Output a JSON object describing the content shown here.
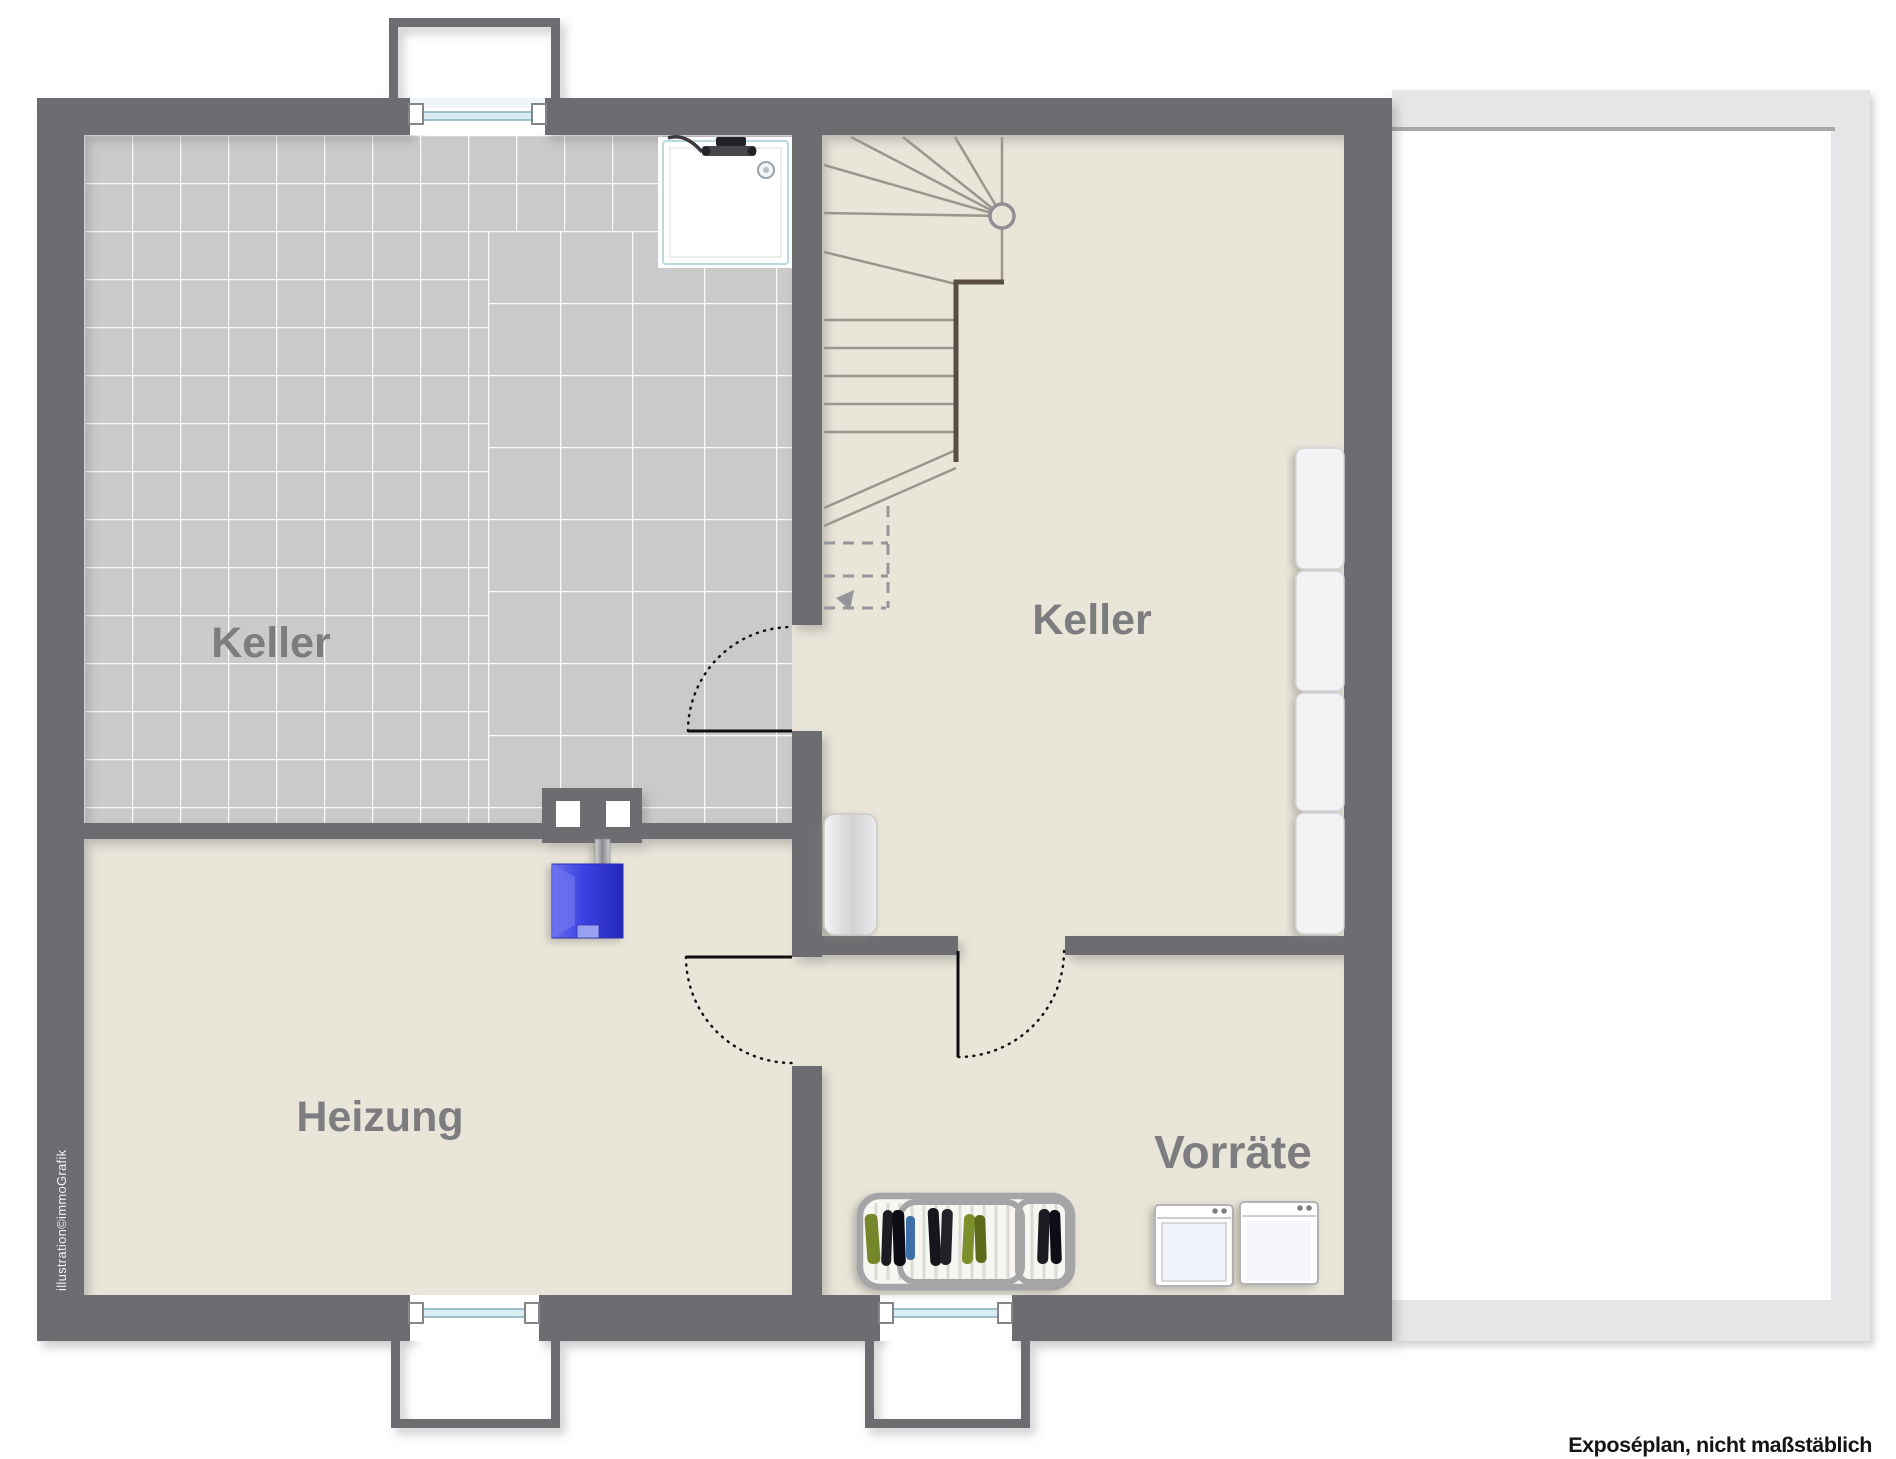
{
  "rooms": {
    "keller_left": {
      "label": "Keller"
    },
    "keller_right": {
      "label": "Keller"
    },
    "heizung": {
      "label": "Heizung"
    },
    "vorraete": {
      "label": "Vorräte"
    }
  },
  "annotations": {
    "credit": "illustration©immoGrafik",
    "disclaimer": "Exposéplan, nicht maßstäblich"
  },
  "fixtures": {
    "staircase": "winder-staircase-with-section-cut",
    "shower": "shower-tray-with-fixture-and-drain",
    "chimney": "chimney-block-two-flues",
    "boiler": "blue-heating-boiler-with-flue-pipe",
    "radiator": "white-tank-radiator",
    "shelves": "four-shelf-units-right-wall",
    "drying_rack": "laundry-drying-rack-with-clothes",
    "appliances": "washing-machine-and-dryer",
    "windows": "three-basement-windows-with-light-wells",
    "doors": "three-swing-doors",
    "terrace": "light-gray-terrace-outline"
  },
  "colors": {
    "wall": "#6c6c71",
    "tile": "#cacaca",
    "floor": "#e9e5d9",
    "label": "#7d7d80",
    "stairLine": "#9b968d",
    "stairDark": "#584e44",
    "dash": "#95959a",
    "glass": "#d8ecf2",
    "glassEdge": "#86aeba",
    "terrace": "#e6e6e8",
    "terraceLine": "#a8a8aa",
    "boilerBlue": "#3a41e2",
    "boilerLight": "#98a0f2",
    "clothesGreen": "#76862c",
    "clothesBlack": "#1b1b20",
    "clothesBlue": "#3d6fa8"
  }
}
